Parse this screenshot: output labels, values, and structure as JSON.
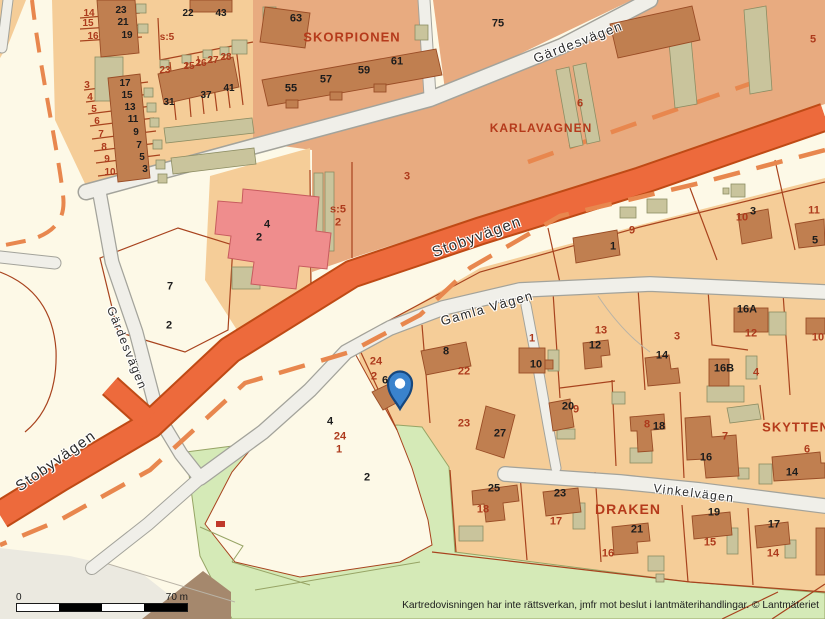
{
  "map": {
    "attribution": "Kartredovisningen har inte rättsverkan, jmfr mot beslut i lantmäterihandlingar. © Lantmäteriet",
    "scalebar": {
      "start_label": "0",
      "end_label": "70 m"
    },
    "palette": {
      "cream": "#fdf9e7",
      "tan": "#f5cd98",
      "salmon": "#e8ab80",
      "green": "#d5eab7",
      "green_edge": "#97a465",
      "gray_zone": "#ebe9e0",
      "road_fill": "#f0efe9",
      "road_edge": "#a3a39b",
      "band": "#ed6a3c",
      "band_edge": "#bf4a15",
      "dash": "#e8874e",
      "boundary": "#a8431e",
      "building": "#c07f50",
      "building_edge": "#9a4d26",
      "olive": "#c9c49c",
      "olive_edge": "#8d8d63",
      "pink": "#ef8d8d",
      "pink_edge": "#c75b5e",
      "red_text": "#ad3a1c",
      "dark_text": "#1c1c1c",
      "street_text": "#2b2b2b",
      "area_text": "#b53a1b",
      "pin_fill": "#3a83cd",
      "pin_edge": "#16477e",
      "triangle": "#a5886d"
    },
    "streets": [
      {
        "text": "Gärdesvägen",
        "x": 578,
        "y": 42,
        "r": -21,
        "cls": "street",
        "size": 13
      },
      {
        "text": "Stobyvägen",
        "x": 477,
        "y": 237,
        "r": -20,
        "cls": "street",
        "size": 15
      },
      {
        "text": "Gärdesvägen",
        "x": 127,
        "y": 348,
        "r": 68,
        "cls": "street",
        "size": 12
      },
      {
        "text": "Stobyvägen",
        "x": 56,
        "y": 461,
        "r": -35,
        "cls": "street",
        "size": 15
      },
      {
        "text": "Gamla Vägen",
        "x": 487,
        "y": 308,
        "r": -16,
        "cls": "street",
        "size": 13
      },
      {
        "text": "Vinkelvägen",
        "x": 694,
        "y": 493,
        "r": 7,
        "cls": "street",
        "size": 12
      }
    ],
    "areas": [
      {
        "text": "SKORPIONEN",
        "x": 352,
        "y": 37,
        "r": 0,
        "cls": "area",
        "size": 13
      },
      {
        "text": "KARLAVAGNEN",
        "x": 541,
        "y": 128,
        "r": 0,
        "cls": "area",
        "size": 12
      },
      {
        "text": "SKYTTEN",
        "x": 796,
        "y": 427,
        "r": 0,
        "cls": "area",
        "size": 13
      },
      {
        "text": "DRAKEN",
        "x": 628,
        "y": 509,
        "r": 0,
        "cls": "area",
        "size": 14
      }
    ],
    "parcel_numbers": [
      {
        "text": "14",
        "x": 89,
        "y": 14,
        "cls": "red",
        "size": 10
      },
      {
        "text": "15",
        "x": 88,
        "y": 24,
        "cls": "red",
        "size": 10
      },
      {
        "text": "16",
        "x": 93,
        "y": 37,
        "cls": "red",
        "size": 10
      },
      {
        "text": "3",
        "x": 87,
        "y": 86,
        "cls": "red",
        "size": 10
      },
      {
        "text": "4",
        "x": 90,
        "y": 98,
        "cls": "red",
        "size": 10
      },
      {
        "text": "5",
        "x": 94,
        "y": 110,
        "cls": "red",
        "size": 10
      },
      {
        "text": "6",
        "x": 97,
        "y": 122,
        "cls": "red",
        "size": 10
      },
      {
        "text": "7",
        "x": 101,
        "y": 135,
        "cls": "red",
        "size": 10
      },
      {
        "text": "8",
        "x": 104,
        "y": 148,
        "cls": "red",
        "size": 10
      },
      {
        "text": "9",
        "x": 107,
        "y": 160,
        "cls": "red",
        "size": 10
      },
      {
        "text": "10",
        "x": 110,
        "y": 173,
        "cls": "red",
        "size": 10
      },
      {
        "text": "s:5",
        "x": 167,
        "y": 38,
        "cls": "red",
        "size": 10
      },
      {
        "text": "23",
        "x": 165,
        "y": 71,
        "cls": "red",
        "size": 10
      },
      {
        "text": "25",
        "x": 189,
        "y": 67,
        "cls": "red",
        "size": 10
      },
      {
        "text": "26",
        "x": 201,
        "y": 64,
        "cls": "red",
        "size": 10
      },
      {
        "text": "27",
        "x": 213,
        "y": 61,
        "cls": "red",
        "size": 10
      },
      {
        "text": "28",
        "x": 226,
        "y": 58,
        "cls": "red",
        "size": 10
      },
      {
        "text": "23",
        "x": 121,
        "y": 11,
        "cls": "dark",
        "size": 10
      },
      {
        "text": "21",
        "x": 123,
        "y": 23,
        "cls": "dark",
        "size": 10
      },
      {
        "text": "19",
        "x": 127,
        "y": 36,
        "cls": "dark",
        "size": 10
      },
      {
        "text": "22",
        "x": 188,
        "y": 14,
        "cls": "dark",
        "size": 10
      },
      {
        "text": "43",
        "x": 221,
        "y": 14,
        "cls": "dark",
        "size": 10
      },
      {
        "text": "17",
        "x": 125,
        "y": 84,
        "cls": "dark",
        "size": 10
      },
      {
        "text": "15",
        "x": 127,
        "y": 96,
        "cls": "dark",
        "size": 10
      },
      {
        "text": "13",
        "x": 130,
        "y": 108,
        "cls": "dark",
        "size": 10
      },
      {
        "text": "11",
        "x": 133,
        "y": 120,
        "cls": "dark",
        "size": 10
      },
      {
        "text": "9",
        "x": 136,
        "y": 133,
        "cls": "dark",
        "size": 10
      },
      {
        "text": "7",
        "x": 139,
        "y": 146,
        "cls": "dark",
        "size": 10
      },
      {
        "text": "5",
        "x": 142,
        "y": 158,
        "cls": "dark",
        "size": 10
      },
      {
        "text": "3",
        "x": 145,
        "y": 170,
        "cls": "dark",
        "size": 10
      },
      {
        "text": "31",
        "x": 169,
        "y": 103,
        "cls": "dark",
        "size": 10
      },
      {
        "text": "37",
        "x": 206,
        "y": 96,
        "cls": "dark",
        "size": 10
      },
      {
        "text": "41",
        "x": 229,
        "y": 89,
        "cls": "dark",
        "size": 10
      },
      {
        "text": "63",
        "x": 296,
        "y": 19,
        "cls": "dark"
      },
      {
        "text": "55",
        "x": 291,
        "y": 89,
        "cls": "dark"
      },
      {
        "text": "57",
        "x": 326,
        "y": 80,
        "cls": "dark"
      },
      {
        "text": "59",
        "x": 364,
        "y": 71,
        "cls": "dark"
      },
      {
        "text": "61",
        "x": 397,
        "y": 62,
        "cls": "dark"
      },
      {
        "text": "75",
        "x": 498,
        "y": 24,
        "cls": "dark"
      },
      {
        "text": "s:5",
        "x": 338,
        "y": 210,
        "cls": "red"
      },
      {
        "text": "2",
        "x": 338,
        "y": 223,
        "cls": "red"
      },
      {
        "text": "3",
        "x": 407,
        "y": 177,
        "cls": "red"
      },
      {
        "text": "6",
        "x": 580,
        "y": 104,
        "cls": "red"
      },
      {
        "text": "5",
        "x": 813,
        "y": 40,
        "cls": "red"
      },
      {
        "text": "4",
        "x": 267,
        "y": 225,
        "cls": "dark"
      },
      {
        "text": "2",
        "x": 259,
        "y": 238,
        "cls": "dark"
      },
      {
        "text": "7",
        "x": 170,
        "y": 287,
        "cls": "dark"
      },
      {
        "text": "2",
        "x": 169,
        "y": 326,
        "cls": "dark"
      },
      {
        "text": "24",
        "x": 376,
        "y": 362,
        "cls": "red"
      },
      {
        "text": "2",
        "x": 374,
        "y": 377,
        "cls": "red"
      },
      {
        "text": "6",
        "x": 385,
        "y": 381,
        "cls": "dark"
      },
      {
        "text": "8",
        "x": 446,
        "y": 352,
        "cls": "dark"
      },
      {
        "text": "22",
        "x": 464,
        "y": 372,
        "cls": "red"
      },
      {
        "text": "4",
        "x": 330,
        "y": 422,
        "cls": "dark"
      },
      {
        "text": "24",
        "x": 340,
        "y": 437,
        "cls": "red"
      },
      {
        "text": "1",
        "x": 339,
        "y": 450,
        "cls": "red"
      },
      {
        "text": "2",
        "x": 367,
        "y": 478,
        "cls": "dark"
      },
      {
        "text": "9",
        "x": 632,
        "y": 231,
        "cls": "red"
      },
      {
        "text": "1",
        "x": 613,
        "y": 247,
        "cls": "dark"
      },
      {
        "text": "10",
        "x": 742,
        "y": 218,
        "cls": "red"
      },
      {
        "text": "3",
        "x": 753,
        "y": 212,
        "cls": "dark"
      },
      {
        "text": "11",
        "x": 814,
        "y": 211,
        "cls": "red"
      },
      {
        "text": "5",
        "x": 815,
        "y": 241,
        "cls": "dark"
      },
      {
        "text": "1",
        "x": 532,
        "y": 339,
        "cls": "red"
      },
      {
        "text": "10",
        "x": 536,
        "y": 365,
        "cls": "dark"
      },
      {
        "text": "13",
        "x": 601,
        "y": 331,
        "cls": "red"
      },
      {
        "text": "12",
        "x": 595,
        "y": 346,
        "cls": "dark"
      },
      {
        "text": "3",
        "x": 677,
        "y": 337,
        "cls": "red"
      },
      {
        "text": "16A",
        "x": 747,
        "y": 310,
        "cls": "dark"
      },
      {
        "text": "12",
        "x": 751,
        "y": 334,
        "cls": "red"
      },
      {
        "text": "10",
        "x": 818,
        "y": 338,
        "cls": "red"
      },
      {
        "text": "14",
        "x": 662,
        "y": 356,
        "cls": "dark"
      },
      {
        "text": "16B",
        "x": 724,
        "y": 369,
        "cls": "dark"
      },
      {
        "text": "4",
        "x": 756,
        "y": 373,
        "cls": "red"
      },
      {
        "text": "20",
        "x": 568,
        "y": 407,
        "cls": "dark"
      },
      {
        "text": "9",
        "x": 576,
        "y": 410,
        "cls": "red"
      },
      {
        "text": "23",
        "x": 464,
        "y": 424,
        "cls": "red"
      },
      {
        "text": "27",
        "x": 500,
        "y": 434,
        "cls": "dark"
      },
      {
        "text": "8",
        "x": 647,
        "y": 425,
        "cls": "red"
      },
      {
        "text": "18",
        "x": 659,
        "y": 427,
        "cls": "dark"
      },
      {
        "text": "7",
        "x": 725,
        "y": 437,
        "cls": "red"
      },
      {
        "text": "16",
        "x": 706,
        "y": 458,
        "cls": "dark"
      },
      {
        "text": "6",
        "x": 807,
        "y": 450,
        "cls": "red"
      },
      {
        "text": "14",
        "x": 792,
        "y": 473,
        "cls": "dark"
      },
      {
        "text": "25",
        "x": 494,
        "y": 489,
        "cls": "dark"
      },
      {
        "text": "18",
        "x": 483,
        "y": 510,
        "cls": "red"
      },
      {
        "text": "23",
        "x": 560,
        "y": 494,
        "cls": "dark"
      },
      {
        "text": "17",
        "x": 556,
        "y": 522,
        "cls": "red"
      },
      {
        "text": "21",
        "x": 637,
        "y": 530,
        "cls": "dark"
      },
      {
        "text": "16",
        "x": 608,
        "y": 554,
        "cls": "red"
      },
      {
        "text": "19",
        "x": 714,
        "y": 513,
        "cls": "dark"
      },
      {
        "text": "15",
        "x": 710,
        "y": 543,
        "cls": "red"
      },
      {
        "text": "17",
        "x": 774,
        "y": 525,
        "cls": "dark"
      },
      {
        "text": "14",
        "x": 773,
        "y": 554,
        "cls": "red"
      }
    ]
  }
}
